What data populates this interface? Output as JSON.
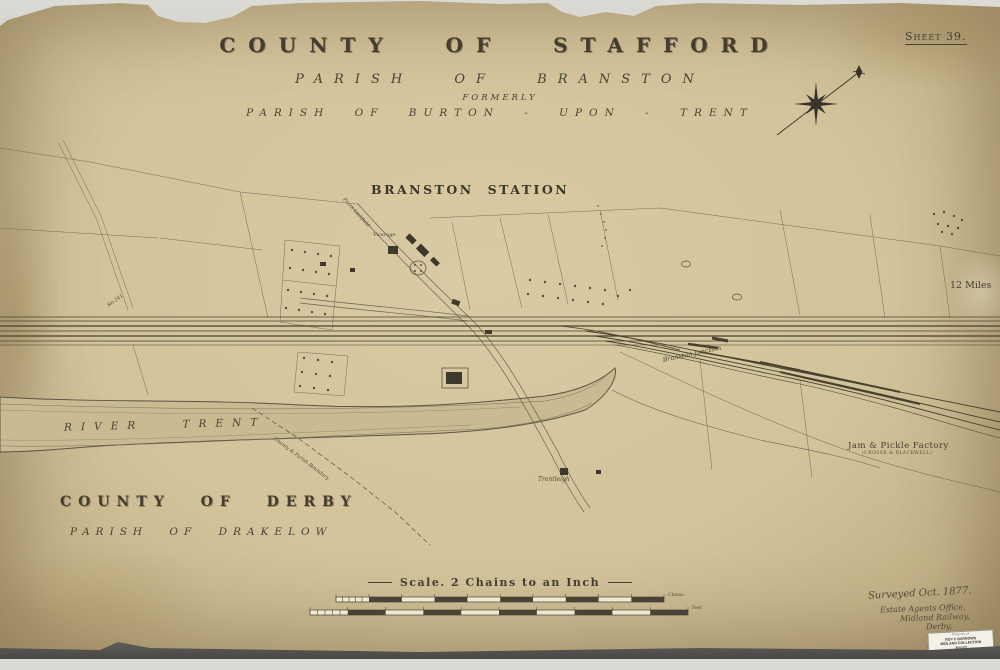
{
  "sheet": {
    "label": "Sheet 39."
  },
  "titles": {
    "county": "COUNTY OF STAFFORD",
    "parish": "PARISH OF BRANSTON",
    "formerly": "FORMERLY",
    "former_parish": "PARISH OF BURTON - UPON - TRENT"
  },
  "station": {
    "label": "BRANSTON STATION"
  },
  "labels": {
    "vicarage": "Vicarage",
    "from_lichfield": "From Lichfield",
    "bridge_no": "No 241",
    "junction": "Branston Junction",
    "river": "RIVER TRENT",
    "boundary": "County & Parish Boundary",
    "trentleigh": "Trentleigh",
    "miles": "12 Miles",
    "factory": "Jam & Pickle Factory",
    "factory_sub": "(CROSSE & BLACKWELL)",
    "county_derby": "COUNTY OF DERBY",
    "parish_drakelow": "PARISH OF DRAKELOW"
  },
  "scale": {
    "title": "Scale. 2 Chains to an Inch",
    "chains_label": "Chains",
    "feet_label": "Feet"
  },
  "imprint": {
    "surveyed": "Surveyed Oct. 1877.",
    "line1": "Estate Agents Office,",
    "line2": "Midland Railway,",
    "line3": "Derby."
  },
  "sticker": {
    "line1": "Property of",
    "line2": "ROY F BURROWS",
    "line3": "MIDLAND COLLECTION",
    "line4": "TRUST",
    "item": "Item No. 96040"
  },
  "colors": {
    "paper": "#d3c39b",
    "paper_edge": "#ab986f",
    "ink": "#3f382c",
    "backdrop": "#b3b1ac"
  }
}
